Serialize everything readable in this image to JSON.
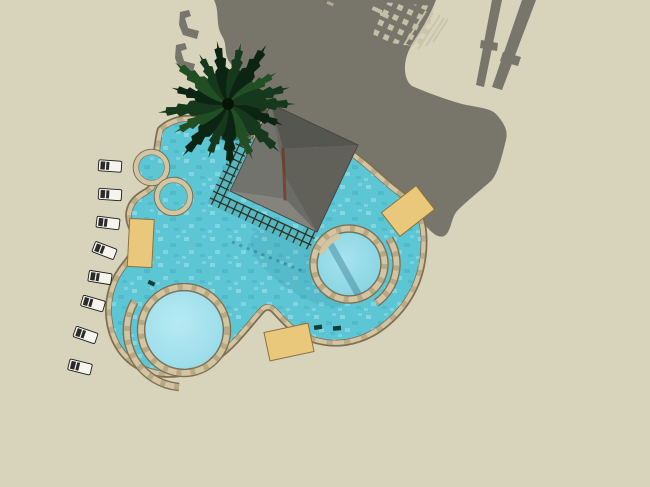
{
  "scene": {
    "title": "Resort pool complex — top-down 3D render",
    "view": "plan view (bird's eye) architectural rendering, no UI chrome or text",
    "lighting": "sun from lower-left; shadows of palm tree, pergola roof, lattice and posts cast toward upper-right",
    "objects": {
      "main_pool": "freeform two-lobe lagoon pool with stone coping",
      "spa_circles": {
        "count": 2,
        "position": "upper-left, attached to main pool"
      },
      "round_kids_pool": {
        "count": 1,
        "position": "lower-left lobe, ringed by stone coping"
      },
      "round_spa_pool": {
        "count": 1,
        "position": "right lobe, ringed by stone coping"
      },
      "walkway_arcs": {
        "count": 3,
        "description": "curved stone arcs inside pool lobes"
      },
      "pergola": "square lattice-edged hip-roof pavilion rotated ~25deg over pool top edge",
      "palm_tree": {
        "count": 1,
        "position": "top-left of pergola overhanging pool"
      },
      "lounge_chairs": {
        "count": 8,
        "position": "diagonal row along left side"
      },
      "sun_mats": {
        "count": 3,
        "description": "tan rectangular platforms at pool edge"
      },
      "pool_lights": {
        "count": 3,
        "description": "small dark fittings on coping"
      },
      "cast_shadow": "large merged palm/pergola shadow blob with two post shadows and lattice shadow pattern",
      "chair_shadows": {
        "count": 2,
        "position": "top-left in shadow area"
      }
    }
  },
  "palette": {
    "ground": "#d8d3bb",
    "shadow": "#78756a",
    "shadowLight": "#c9c5ac",
    "water": "#5cc6d4",
    "waterLightA": "#b7eaf3",
    "waterLightB": "#8fd8e5",
    "coping": "#d3c5a2",
    "copingJoint": "#a3916e",
    "copingEdge": "#7e6f52",
    "mat": "#eac87b",
    "matEdge": "#8a7340",
    "gapShadow": "#5f5c4f",
    "gapWater": "#57b7c0",
    "latticeTan": "#a3916c",
    "latticeDark": "#1c312e",
    "roofNE": "#5f5f5a",
    "roofSE": "#6c6c66",
    "roofSW": "#84847d",
    "roofNW": "#73736d",
    "roofLine": "#4a4a44",
    "ridge": "#774631",
    "palmDark": "#0c2412",
    "palmMid": "#16381c",
    "palmLight": "#224e24",
    "chairWhite": "#f5f4ee",
    "chairDark": "#2b2b28",
    "lightDot": "#123f3a"
  }
}
